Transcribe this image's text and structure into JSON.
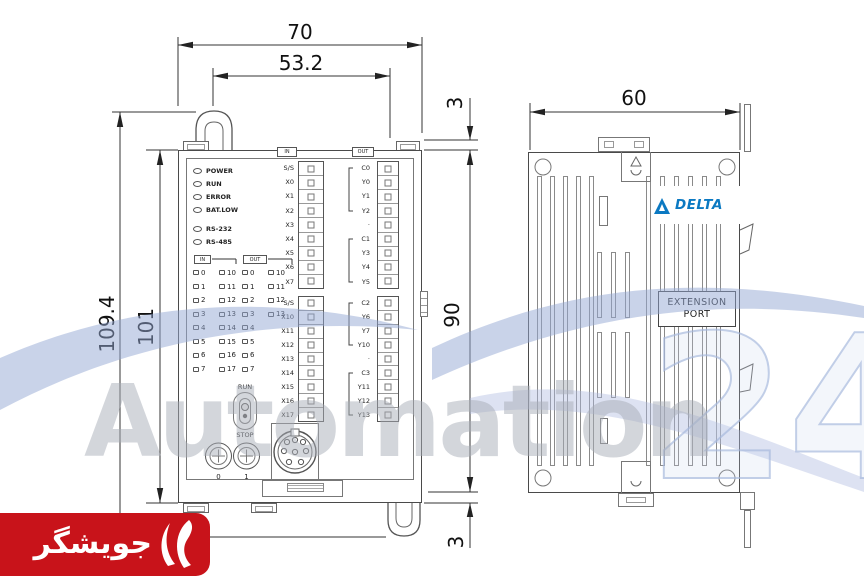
{
  "dimensions": {
    "top_width": "70",
    "inner_width": "53.2",
    "total_height": "109.4",
    "body_height": "101",
    "gap_top": "3",
    "rail_span": "90",
    "gap_bottom": "3",
    "side_width": "60"
  },
  "front_view": {
    "status_leds": [
      "POWER",
      "RUN",
      "ERROR",
      "BAT.LOW",
      "RS-232",
      "RS-485"
    ],
    "terminals": {
      "x_upper": {
        "header": "IN",
        "labels": [
          "S/S",
          "X0",
          "X1",
          "X2",
          "X3",
          "X4",
          "X5",
          "X6",
          "X7"
        ]
      },
      "x_lower": {
        "labels": [
          "S/S",
          "X10",
          "X11",
          "X12",
          "X13",
          "X14",
          "X15",
          "X16",
          "X17"
        ]
      },
      "y_upper": {
        "header": "OUT",
        "labels": [
          "C0",
          "Y0",
          "Y1",
          "Y2",
          "·",
          "C1",
          "Y3",
          "Y4",
          "Y5"
        ]
      },
      "y_lower": {
        "labels": [
          "C2",
          "Y6",
          "Y7",
          "Y10",
          "·",
          "C3",
          "Y11",
          "Y12",
          "Y13"
        ]
      }
    },
    "io_grid_in": {
      "header": "IN",
      "col1": [
        "0",
        "1",
        "2",
        "3",
        "4",
        "5",
        "6",
        "7"
      ],
      "col2": [
        "10",
        "11",
        "12",
        "13",
        "14",
        "15",
        "16",
        "17"
      ]
    },
    "io_grid_out": {
      "header": "OUT",
      "col1": [
        "0",
        "1",
        "2",
        "3",
        "4",
        "5",
        "6",
        "7"
      ],
      "col2": [
        "10",
        "11",
        "12",
        "13"
      ]
    },
    "switch": {
      "top": "RUN",
      "bottom": "STOP"
    },
    "pots": {
      "left": "0",
      "right": "1"
    }
  },
  "side_view": {
    "brand": "DELTA",
    "extension_port": {
      "line1": "EXTENSION",
      "line2": "PORT"
    }
  },
  "watermark": {
    "word": "Automation",
    "number": "24"
  },
  "vendor_banner": {
    "text": "جویشگر"
  }
}
